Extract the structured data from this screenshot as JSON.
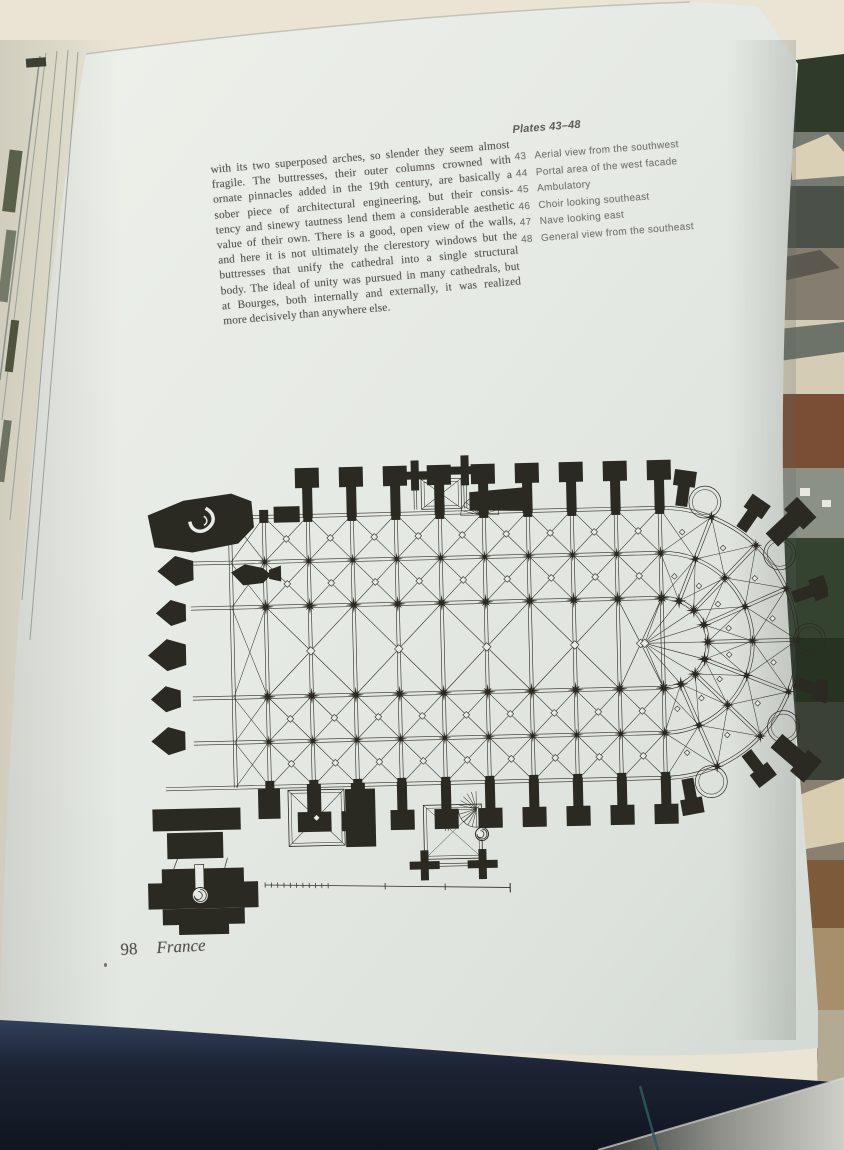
{
  "colors": {
    "page": "#e7eae5",
    "ink": "#56554f",
    "plan_ink": "#2b2a22",
    "cover_navy": "#1a2230",
    "cream_background": "#e9e4d3"
  },
  "paragraph": {
    "lines": [
      "with its two superposed arches, so slender they seem almost",
      "fragile. The buttresses, their outer columns crowned with",
      "ornate pinnacles added in the 19th century, are basically a",
      "sober piece of architectural engineering, but their consis-",
      "tency and sinewy tautness lend them a considerable aesthetic",
      "value of their own. There is a good, open view of the walls,",
      "and here it is not ultimately the clerestory windows but the",
      "buttresses that unify the cathedral into a single structural",
      "body. The ideal of unity was pursued in many cathedrals, but",
      "at Bourges, both internally and externally, it was realized",
      "more decisively than anywhere else."
    ]
  },
  "plates": {
    "title": "Plates 43–48",
    "items": [
      {
        "num": "43",
        "label": "Aerial view from the southwest"
      },
      {
        "num": "44",
        "label": "Portal area of the west facade"
      },
      {
        "num": "45",
        "label": "Ambulatory"
      },
      {
        "num": "46",
        "label": "Choir looking southeast"
      },
      {
        "num": "47",
        "label": "Nave looking east"
      },
      {
        "num": "48",
        "label": "General view from the southeast"
      }
    ]
  },
  "footer": {
    "page_number": "98",
    "section": "France"
  }
}
